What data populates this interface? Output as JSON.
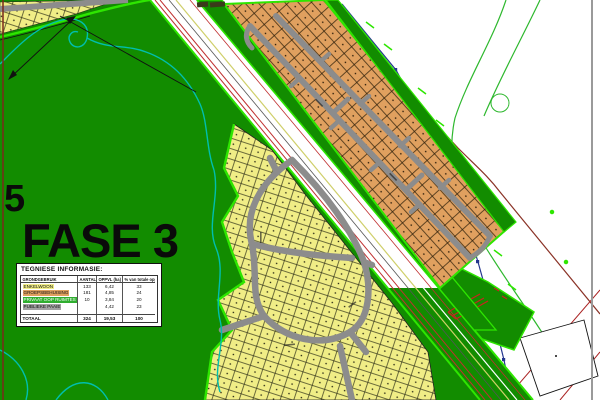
{
  "labels": {
    "phase_big": "FASE 3",
    "phase_side": "5"
  },
  "info_table": {
    "title": "TEGNIESE INFORMASIE:",
    "columns": {
      "land_use": "GRONDGEBRUIK",
      "count": "AANTAL",
      "area": "OPPVL (ha)",
      "pct": "% van totale oppvl."
    },
    "rows": [
      {
        "label": "ENKELWOON",
        "count": "133",
        "area_ha": "6,42",
        "pct": "33",
        "swatch": "#f0ed86"
      },
      {
        "label": "GROEPSBEHUISING",
        "count": "181",
        "area_ha": "4,85",
        "pct": "24",
        "swatch": "#e0a05f"
      },
      {
        "label": "PRIVAAT OOP RUIMTES",
        "count": "10",
        "area_ha": "3,84",
        "pct": "20",
        "swatch": "#2fae2f"
      },
      {
        "label": "PUBLIEKE PAAIE",
        "count": "",
        "area_ha": "4,42",
        "pct": "23",
        "swatch": "#a2a2a2"
      }
    ],
    "total": {
      "label": "TOTAAL",
      "count": "324",
      "area_ha": "19,53",
      "pct": "100"
    }
  },
  "map_colors": {
    "open_space_green": "#128c00",
    "boundary_lime": "#2ee600",
    "residential_yellow": "#f0ed86",
    "group_housing_orange": "#e0a05f",
    "road_gray": "#8c8c8c",
    "stream_teal": "#00bfae",
    "corridor_red": "#c03030",
    "services_navy": "#24368e",
    "contour_brown": "#8a3226",
    "frame_gray": "#9a9a9a"
  }
}
